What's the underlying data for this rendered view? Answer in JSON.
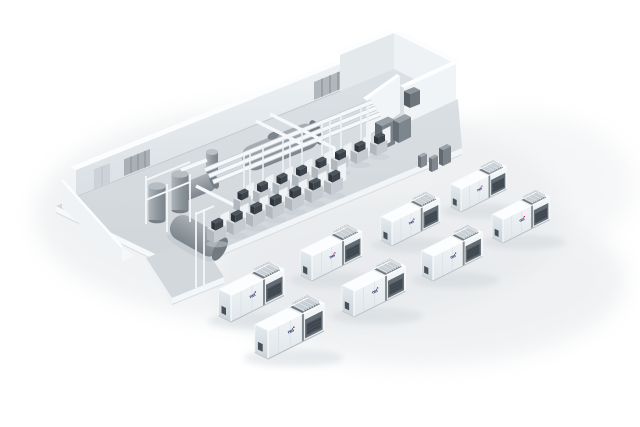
{
  "canvas": {
    "width": 640,
    "height": 427,
    "background_color": "#ffffff"
  },
  "brand": {
    "logo_text": "nel",
    "logo_color": "#27306b",
    "logo_dot_color": "#d4006a"
  },
  "containers": {
    "count": 8,
    "label_text": "nel"
  },
  "building": {
    "rear_machine_row_count": 8,
    "front_machine_row_count": 7,
    "vertical_tank_count": 3,
    "horizontal_tank_count": 3,
    "cabinet_count": 6
  },
  "palette": {
    "floor": "#d6dbdf",
    "wall_face": "#e3e8ec",
    "wall_top": "#fbfdfe",
    "slab_side": "#f6f9fa",
    "partition_wall": "#f2f5f7",
    "tank_gray": "#939ba2",
    "pipe_white": "#f6f9fb",
    "machine_dark": "#3d444b",
    "cabinet_gray": "#7b838a",
    "container_body": "#eef2f5",
    "container_top": "#fcfdfe",
    "container_vent_dark": "#636b73",
    "ground_shadow": "#e6e9ec"
  }
}
